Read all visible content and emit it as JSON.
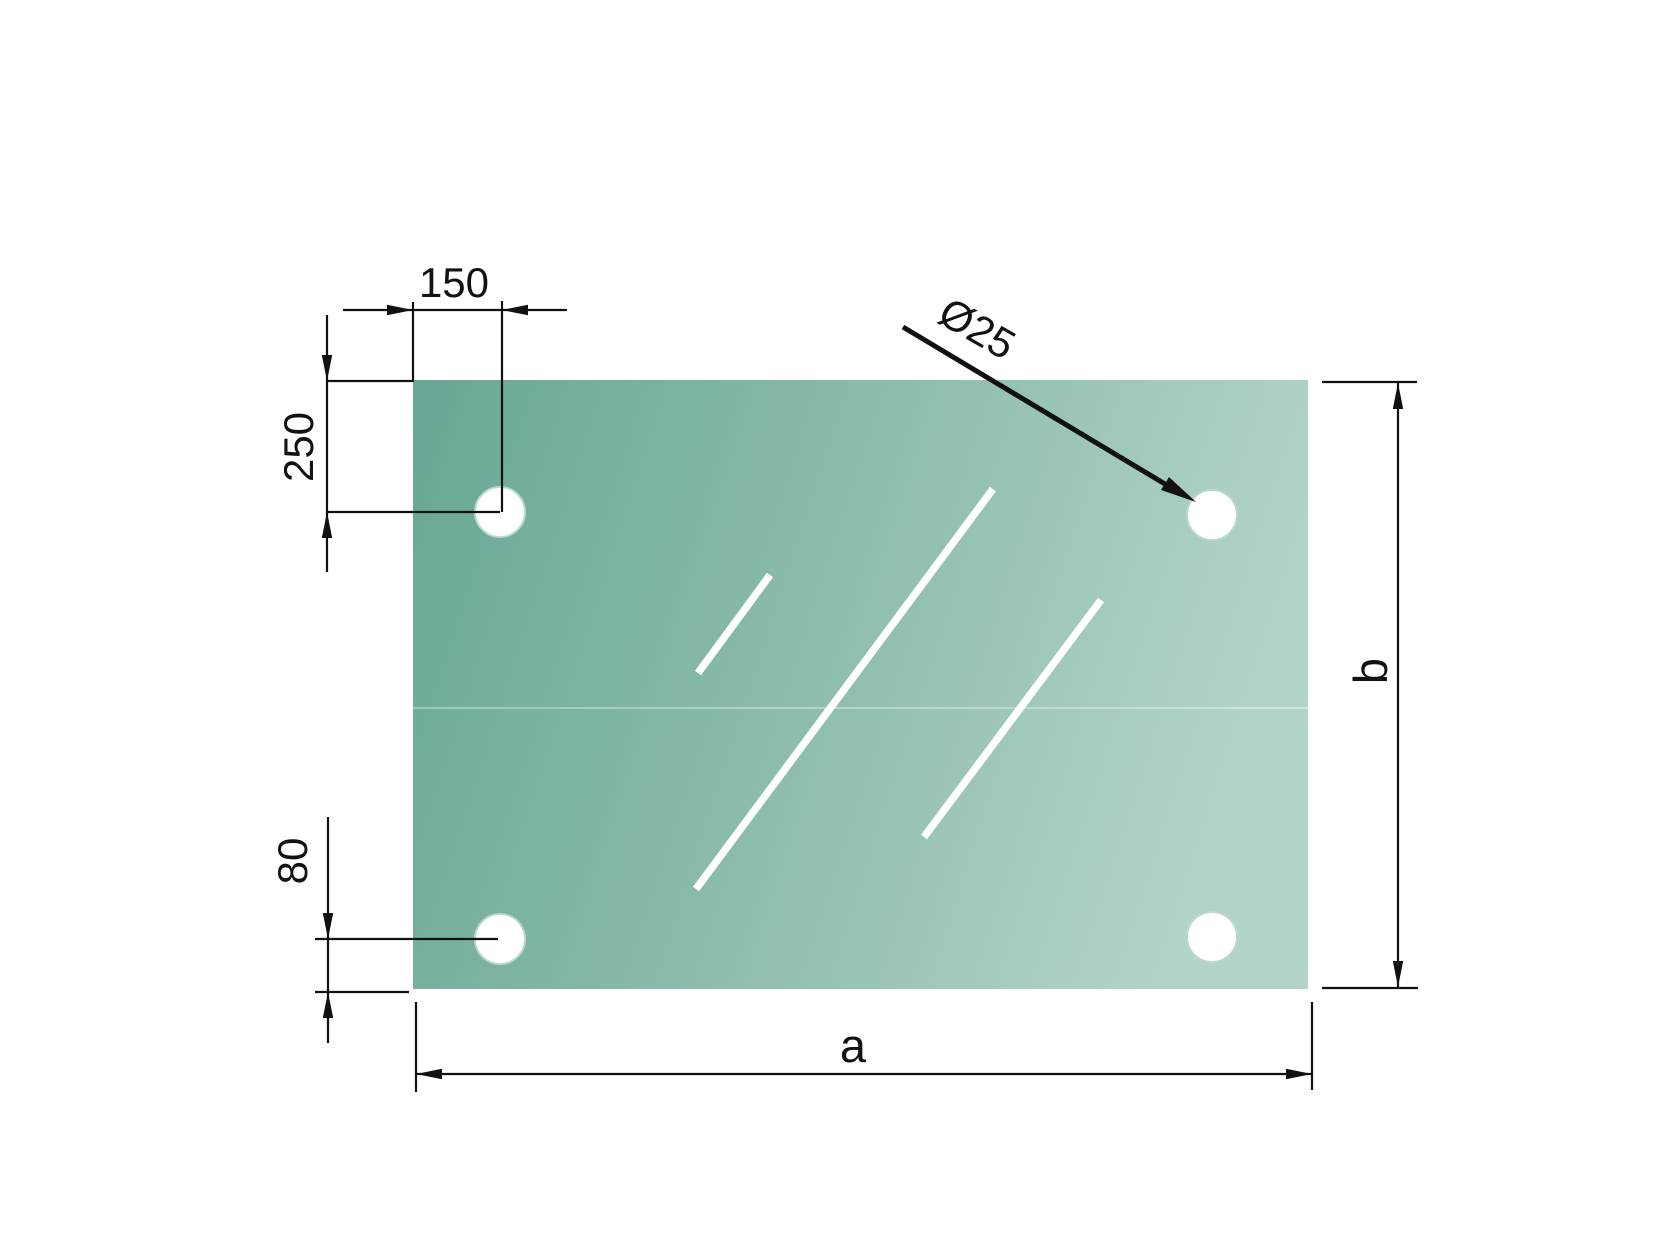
{
  "drawing": {
    "type": "technical-dimension-drawing",
    "part": "rectangular glass panel with four corner mounting holes",
    "labels": {
      "hole_offset_top": "150",
      "hole_offset_side": "250",
      "hole_offset_bottom": "80",
      "hole_diameter": "Ø25",
      "panel_width": "a",
      "panel_height": "b"
    },
    "colors": {
      "panel_gradient_start": "#67a796",
      "panel_gradient_mid": "#8fbdaf",
      "panel_gradient_end": "#b2d3c8",
      "hole_fill": "#ffffff",
      "hole_ring": "#bcd9ce",
      "shine": "#ffffff",
      "dimension_line": "#111111",
      "background": "#ffffff"
    }
  }
}
